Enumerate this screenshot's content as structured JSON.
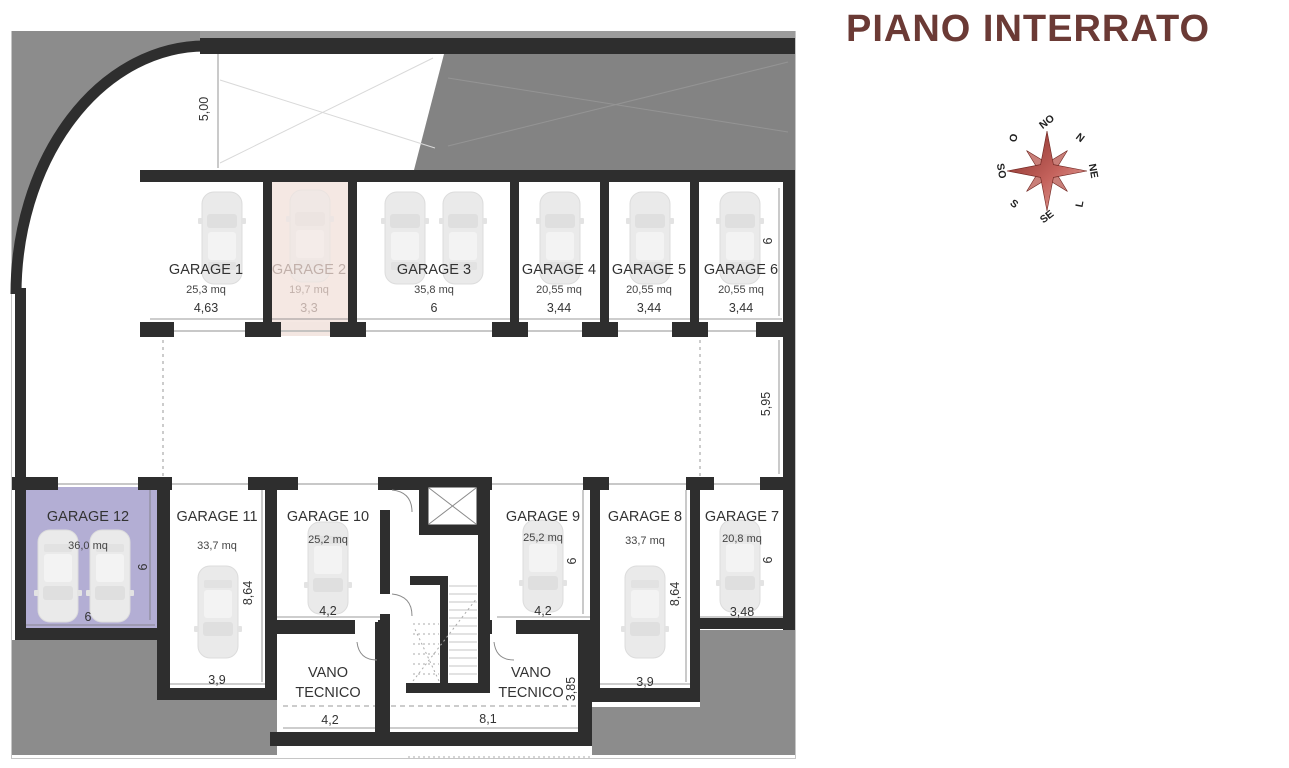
{
  "title": "PIANO INTERRATO",
  "title_color": "#6b3a35",
  "compass": {
    "labels": [
      "NO",
      "N",
      "NE",
      "L",
      "SE",
      "S",
      "SO",
      "O"
    ]
  },
  "plan": {
    "garages": [
      {
        "name": "GARAGE 1",
        "area": "25,3 mq",
        "width": "4,63"
      },
      {
        "name": "GARAGE 2",
        "area": "19,7 mq",
        "width": "3,3",
        "highlight": "#f5e8e3"
      },
      {
        "name": "GARAGE 3",
        "area": "35,8 mq",
        "width": "6"
      },
      {
        "name": "GARAGE 4",
        "area": "20,55 mq",
        "width": "3,44"
      },
      {
        "name": "GARAGE 5",
        "area": "20,55 mq",
        "width": "3,44"
      },
      {
        "name": "GARAGE 6",
        "area": "20,55 mq",
        "width": "3,44",
        "depth": "6"
      },
      {
        "name": "GARAGE 7",
        "area": "20,8 mq",
        "width": "3,48",
        "depth": "6"
      },
      {
        "name": "GARAGE 8",
        "area": "33,7 mq",
        "width": "3,9",
        "depth": "8,64"
      },
      {
        "name": "GARAGE 9",
        "area": "25,2 mq",
        "width": "4,2",
        "depth": "6"
      },
      {
        "name": "GARAGE 10",
        "area": "25,2 mq",
        "width": "4,2"
      },
      {
        "name": "GARAGE 11",
        "area": "33,7 mq",
        "width": "3,9",
        "depth": "8,64"
      },
      {
        "name": "GARAGE 12",
        "area": "36,0 mq",
        "width": "6",
        "depth": "6",
        "highlight": "#b3aed4"
      }
    ],
    "tech_rooms": [
      {
        "line1": "VANO",
        "line2": "TECNICO",
        "width": "4,2"
      },
      {
        "line1": "VANO",
        "line2": "TECNICO",
        "width": "8,1",
        "depth": "3,85"
      }
    ],
    "site_dims": {
      "ramp_width": "5,00",
      "driveway_depth": "5,95"
    }
  }
}
